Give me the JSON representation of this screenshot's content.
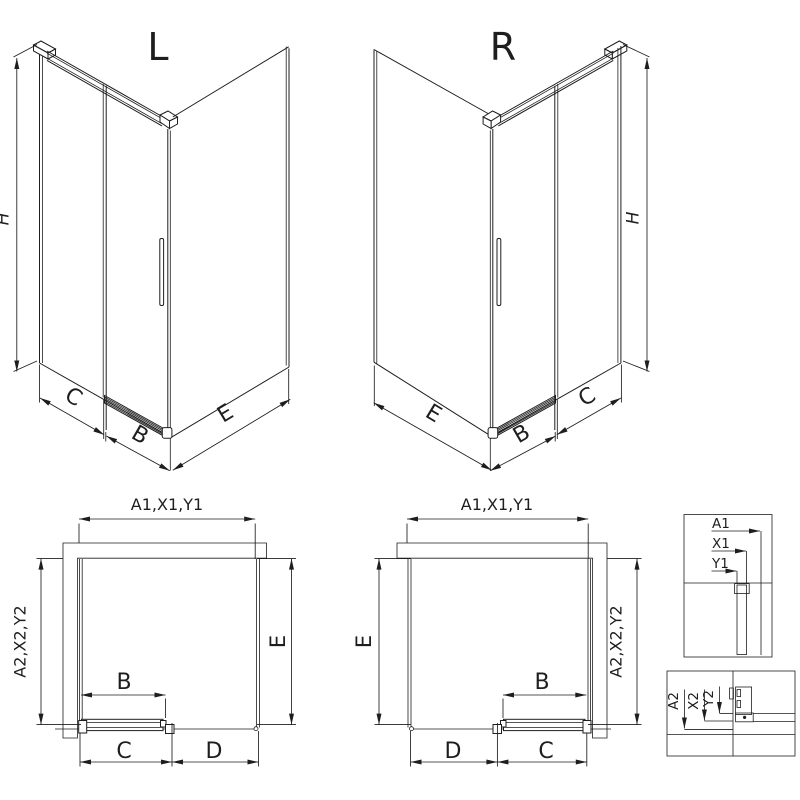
{
  "colors": {
    "line": "#1e1e1e",
    "background": "#ffffff"
  },
  "iso_left": {
    "label": "L",
    "dim_h": "H",
    "dim_c": "C",
    "dim_b": "B",
    "dim_e": "E"
  },
  "iso_right": {
    "label": "R",
    "dim_h": "H",
    "dim_c": "C",
    "dim_b": "B",
    "dim_e": "E"
  },
  "plan_left": {
    "dim_width": "A1,X1,Y1",
    "dim_depth": "A2,X2,Y2",
    "dim_side": "E",
    "dim_b": "B",
    "dim_c": "C",
    "dim_d": "D"
  },
  "plan_right": {
    "dim_width": "A1,X1,Y1",
    "dim_depth": "A2,X2,Y2",
    "dim_side": "E",
    "dim_b": "B",
    "dim_c": "C",
    "dim_d": "D"
  },
  "detail_top": {
    "labels": [
      "A1",
      "X1",
      "Y1"
    ]
  },
  "detail_bottom": {
    "labels": [
      "A2",
      "X2",
      "Y2"
    ]
  }
}
